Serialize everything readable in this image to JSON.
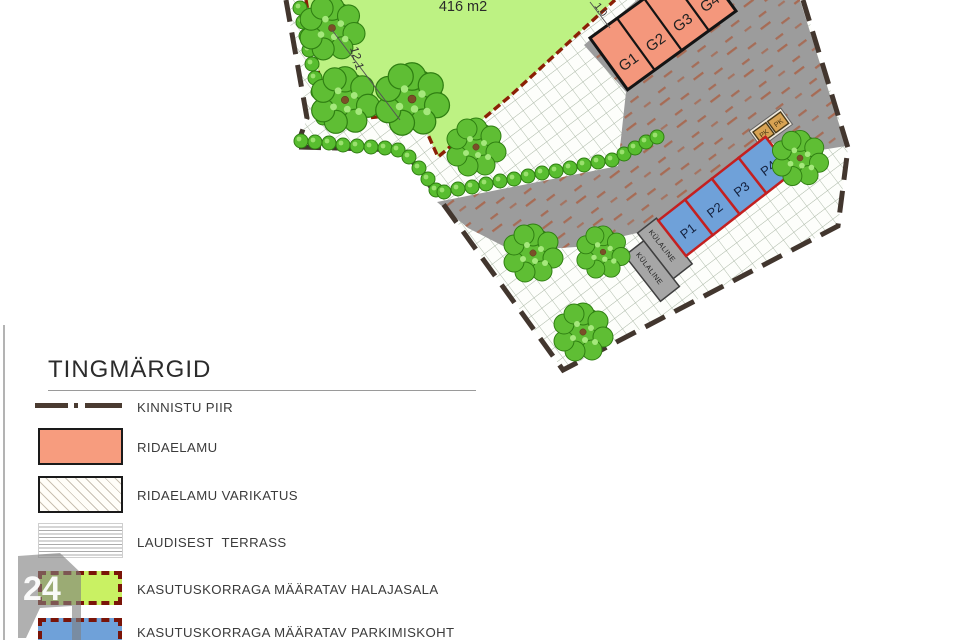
{
  "plan": {
    "area_label": "416 m2",
    "dim_side": "12,1",
    "dim_top": "1,0",
    "garages": [
      "G1",
      "G2",
      "G3",
      "G4"
    ],
    "parking": [
      "P1",
      "P2",
      "P3",
      "P4"
    ],
    "guest": "KÜLALINE",
    "pk": "PK"
  },
  "legend": {
    "title": "TINGMÄRGID",
    "items": [
      {
        "key": "kinnistu-piir",
        "label": "KINNISTU PIIR"
      },
      {
        "key": "ridaelamu",
        "label": "RIDAELAMU"
      },
      {
        "key": "varikatus",
        "label": "RIDAELAMU VARIKATUS"
      },
      {
        "key": "terrass",
        "label": "LAUDISEST  TERRASS"
      },
      {
        "key": "halajasala",
        "label": "KASUTUSKORRAGA MÄÄRATAV HALAJASALA"
      },
      {
        "key": "parkimiskoht",
        "label": "KASUTUSKORRAGA MÄÄRATAV PARKIMISKOHT"
      }
    ]
  },
  "watermark": {
    "number": "24"
  },
  "colors": {
    "lawn": "#bdf283",
    "lawn_border": "#8b2005",
    "road": "#9c9c9c",
    "road_texture": "#aa5a3c",
    "building": "#f79c7e",
    "parking_fill": "#6fa1d9",
    "parking_border": "#c42020",
    "guest_stall": "#a6a6a6",
    "pk_box": "#d8a353",
    "boundary": "#42362e",
    "hatch_line": "#a9b6a4",
    "legend_green": "#c9f163",
    "legend_dash_border": "#7a1408"
  }
}
